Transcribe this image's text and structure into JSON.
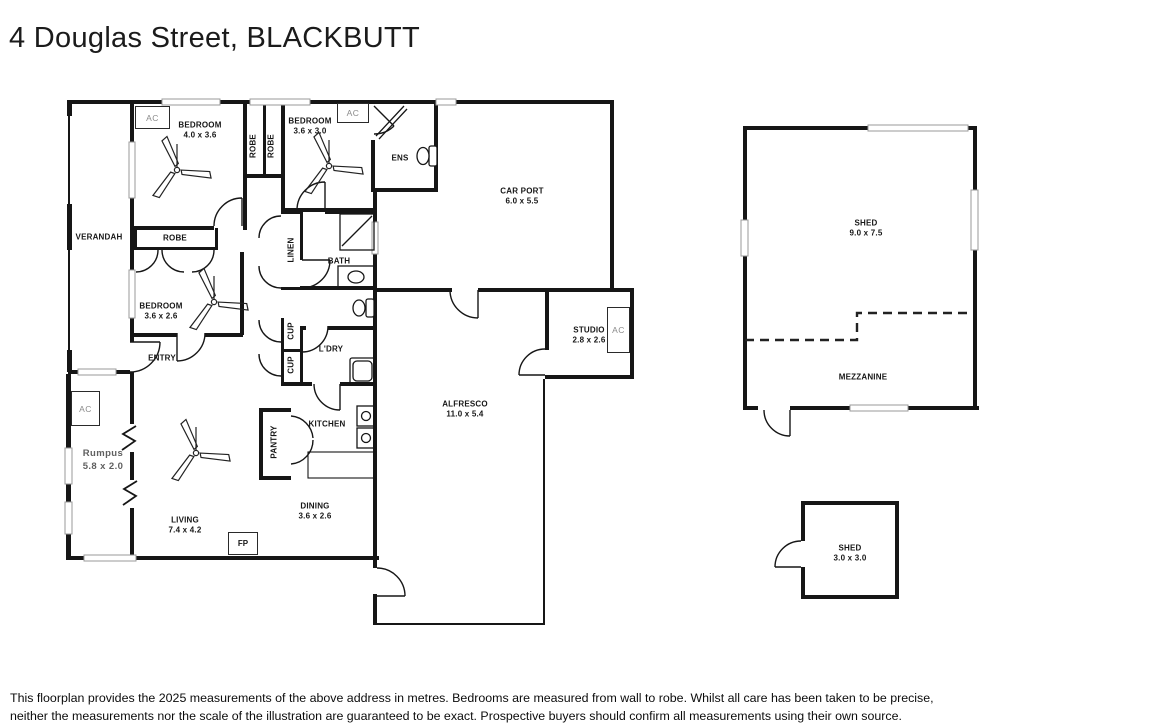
{
  "title": "4 Douglas Street, BLACKBUTT",
  "ac_label": "AC",
  "house": {
    "verandah": "VERANDAH",
    "bedroom1": {
      "name": "BEDROOM",
      "dims": "4.0 x 3.6"
    },
    "bedroom2": {
      "name": "BEDROOM",
      "dims": "3.6 x 3.0"
    },
    "bedroom3": {
      "name": "BEDROOM",
      "dims": "3.6 x 2.6"
    },
    "robe_bed1": "ROBE",
    "robe_bed2": "ROBE",
    "robe_bed3": "ROBE",
    "ens": "ENS",
    "linen": "LINEN",
    "bath": "BATH",
    "entry": "ENTRY",
    "cupboard1": "CUP",
    "cupboard2": "CUP",
    "laundry": "L'DRY",
    "kitchen": "KITCHEN",
    "pantry": "PANTRY",
    "dining": {
      "name": "DINING",
      "dims": "3.6 x 2.6"
    },
    "living": {
      "name": "LIVING",
      "dims": "7.4 x 4.2"
    },
    "rumpus": {
      "name": "Rumpus",
      "dims": "5.8 x 2.0"
    },
    "fireplace": "FP",
    "carport": {
      "name": "CAR PORT",
      "dims": "6.0 x 5.5"
    },
    "alfresco": {
      "name": "ALFRESCO",
      "dims": "11.0 x 5.4"
    },
    "studio": {
      "name": "STUDIO",
      "dims": "2.8 x 2.6"
    }
  },
  "outbuildings": {
    "shed_large": {
      "name": "SHED",
      "dims": "9.0 x 7.5"
    },
    "mezzanine": "MEZZANINE",
    "shed_small": {
      "name": "SHED",
      "dims": "3.0 x 3.0"
    }
  },
  "disclaimer": {
    "line1": "This floorplan provides the 2025 measurements of the above address in metres. Bedrooms are measured from wall to robe. Whilst all care has been taken to be precise,",
    "line2": "neither the measurements nor the scale of the illustration are guaranteed to be exact. Prospective buyers should confirm all measurements using their own source."
  },
  "colors": {
    "wall": "#161616",
    "background": "#ffffff",
    "window": "#9a9a9a",
    "muted_text": "#5f5f5f"
  }
}
